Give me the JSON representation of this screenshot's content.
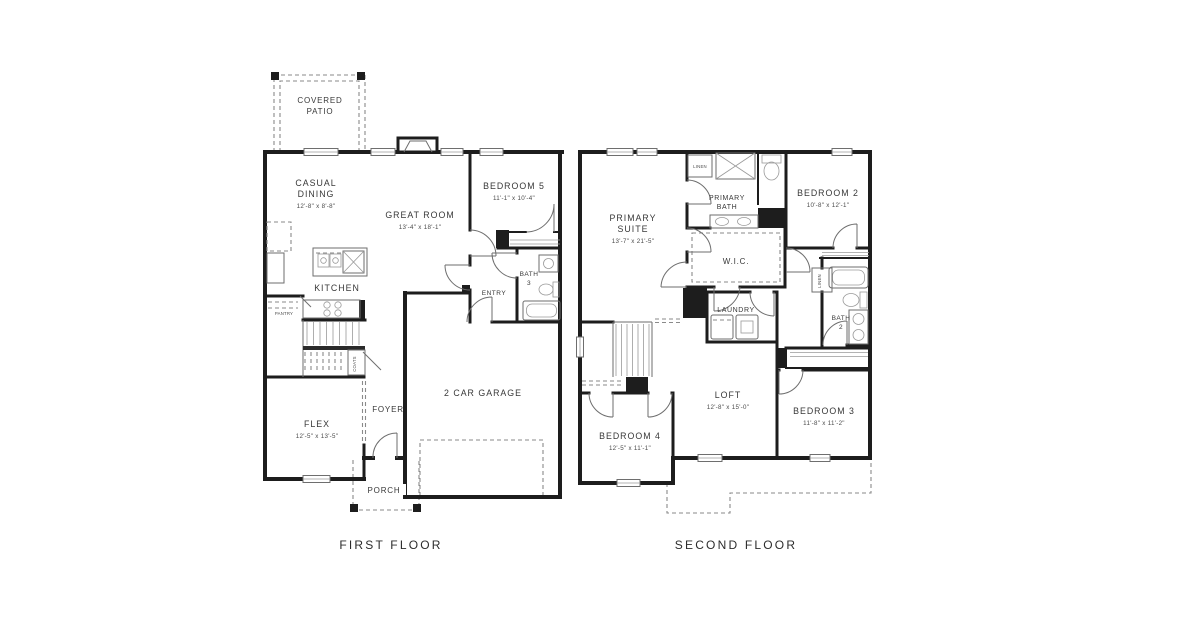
{
  "colors": {
    "bg": "#ffffff",
    "wall": "#1d1d1d",
    "line": "#6e6e6e",
    "text": "#383838"
  },
  "captions": {
    "first": "FIRST FLOOR",
    "second": "SECOND FLOOR"
  },
  "first_floor": {
    "patio_l1": "COVERED",
    "patio_l2": "PATIO",
    "dining_l1": "CASUAL",
    "dining_l2": "DINING",
    "dining_dims": "12'-8\" x 8'-8\"",
    "great_room": "GREAT ROOM",
    "great_room_dims": "13'-4\" x 18'-1\"",
    "bedroom5": "BEDROOM 5",
    "bedroom5_dims": "11'-1\" x 10'-4\"",
    "kitchen": "KITCHEN",
    "pantry": "PANTRY",
    "coats": "COATS",
    "bath_l1": "BATH",
    "bath_l2": "3",
    "entry": "ENTRY",
    "flex": "FLEX",
    "flex_dims": "12'-5\" x 13'-5\"",
    "foyer": "FOYER",
    "garage": "2 CAR GARAGE",
    "porch": "PORCH"
  },
  "second_floor": {
    "suite_l1": "PRIMARY",
    "suite_l2": "SUITE",
    "suite_dims": "13'-7\" x 21'-5\"",
    "linen_bath": "LINEN",
    "pbath_l1": "PRIMARY",
    "pbath_l2": "BATH",
    "bedroom2": "BEDROOM 2",
    "bedroom2_dims": "10'-8\" x 12'-1\"",
    "wic": "W.I.C.",
    "laundry": "LAUNDRY",
    "linen_hall": "LINEN",
    "bath_l1": "BATH",
    "bath_l2": "2",
    "loft": "LOFT",
    "loft_dims": "12'-8\" x 15'-0\"",
    "bedroom3": "BEDROOM 3",
    "bedroom3_dims": "11'-8\" x 11'-2\"",
    "bedroom4": "BEDROOM 4",
    "bedroom4_dims": "12'-5\" x 11'-1\""
  }
}
